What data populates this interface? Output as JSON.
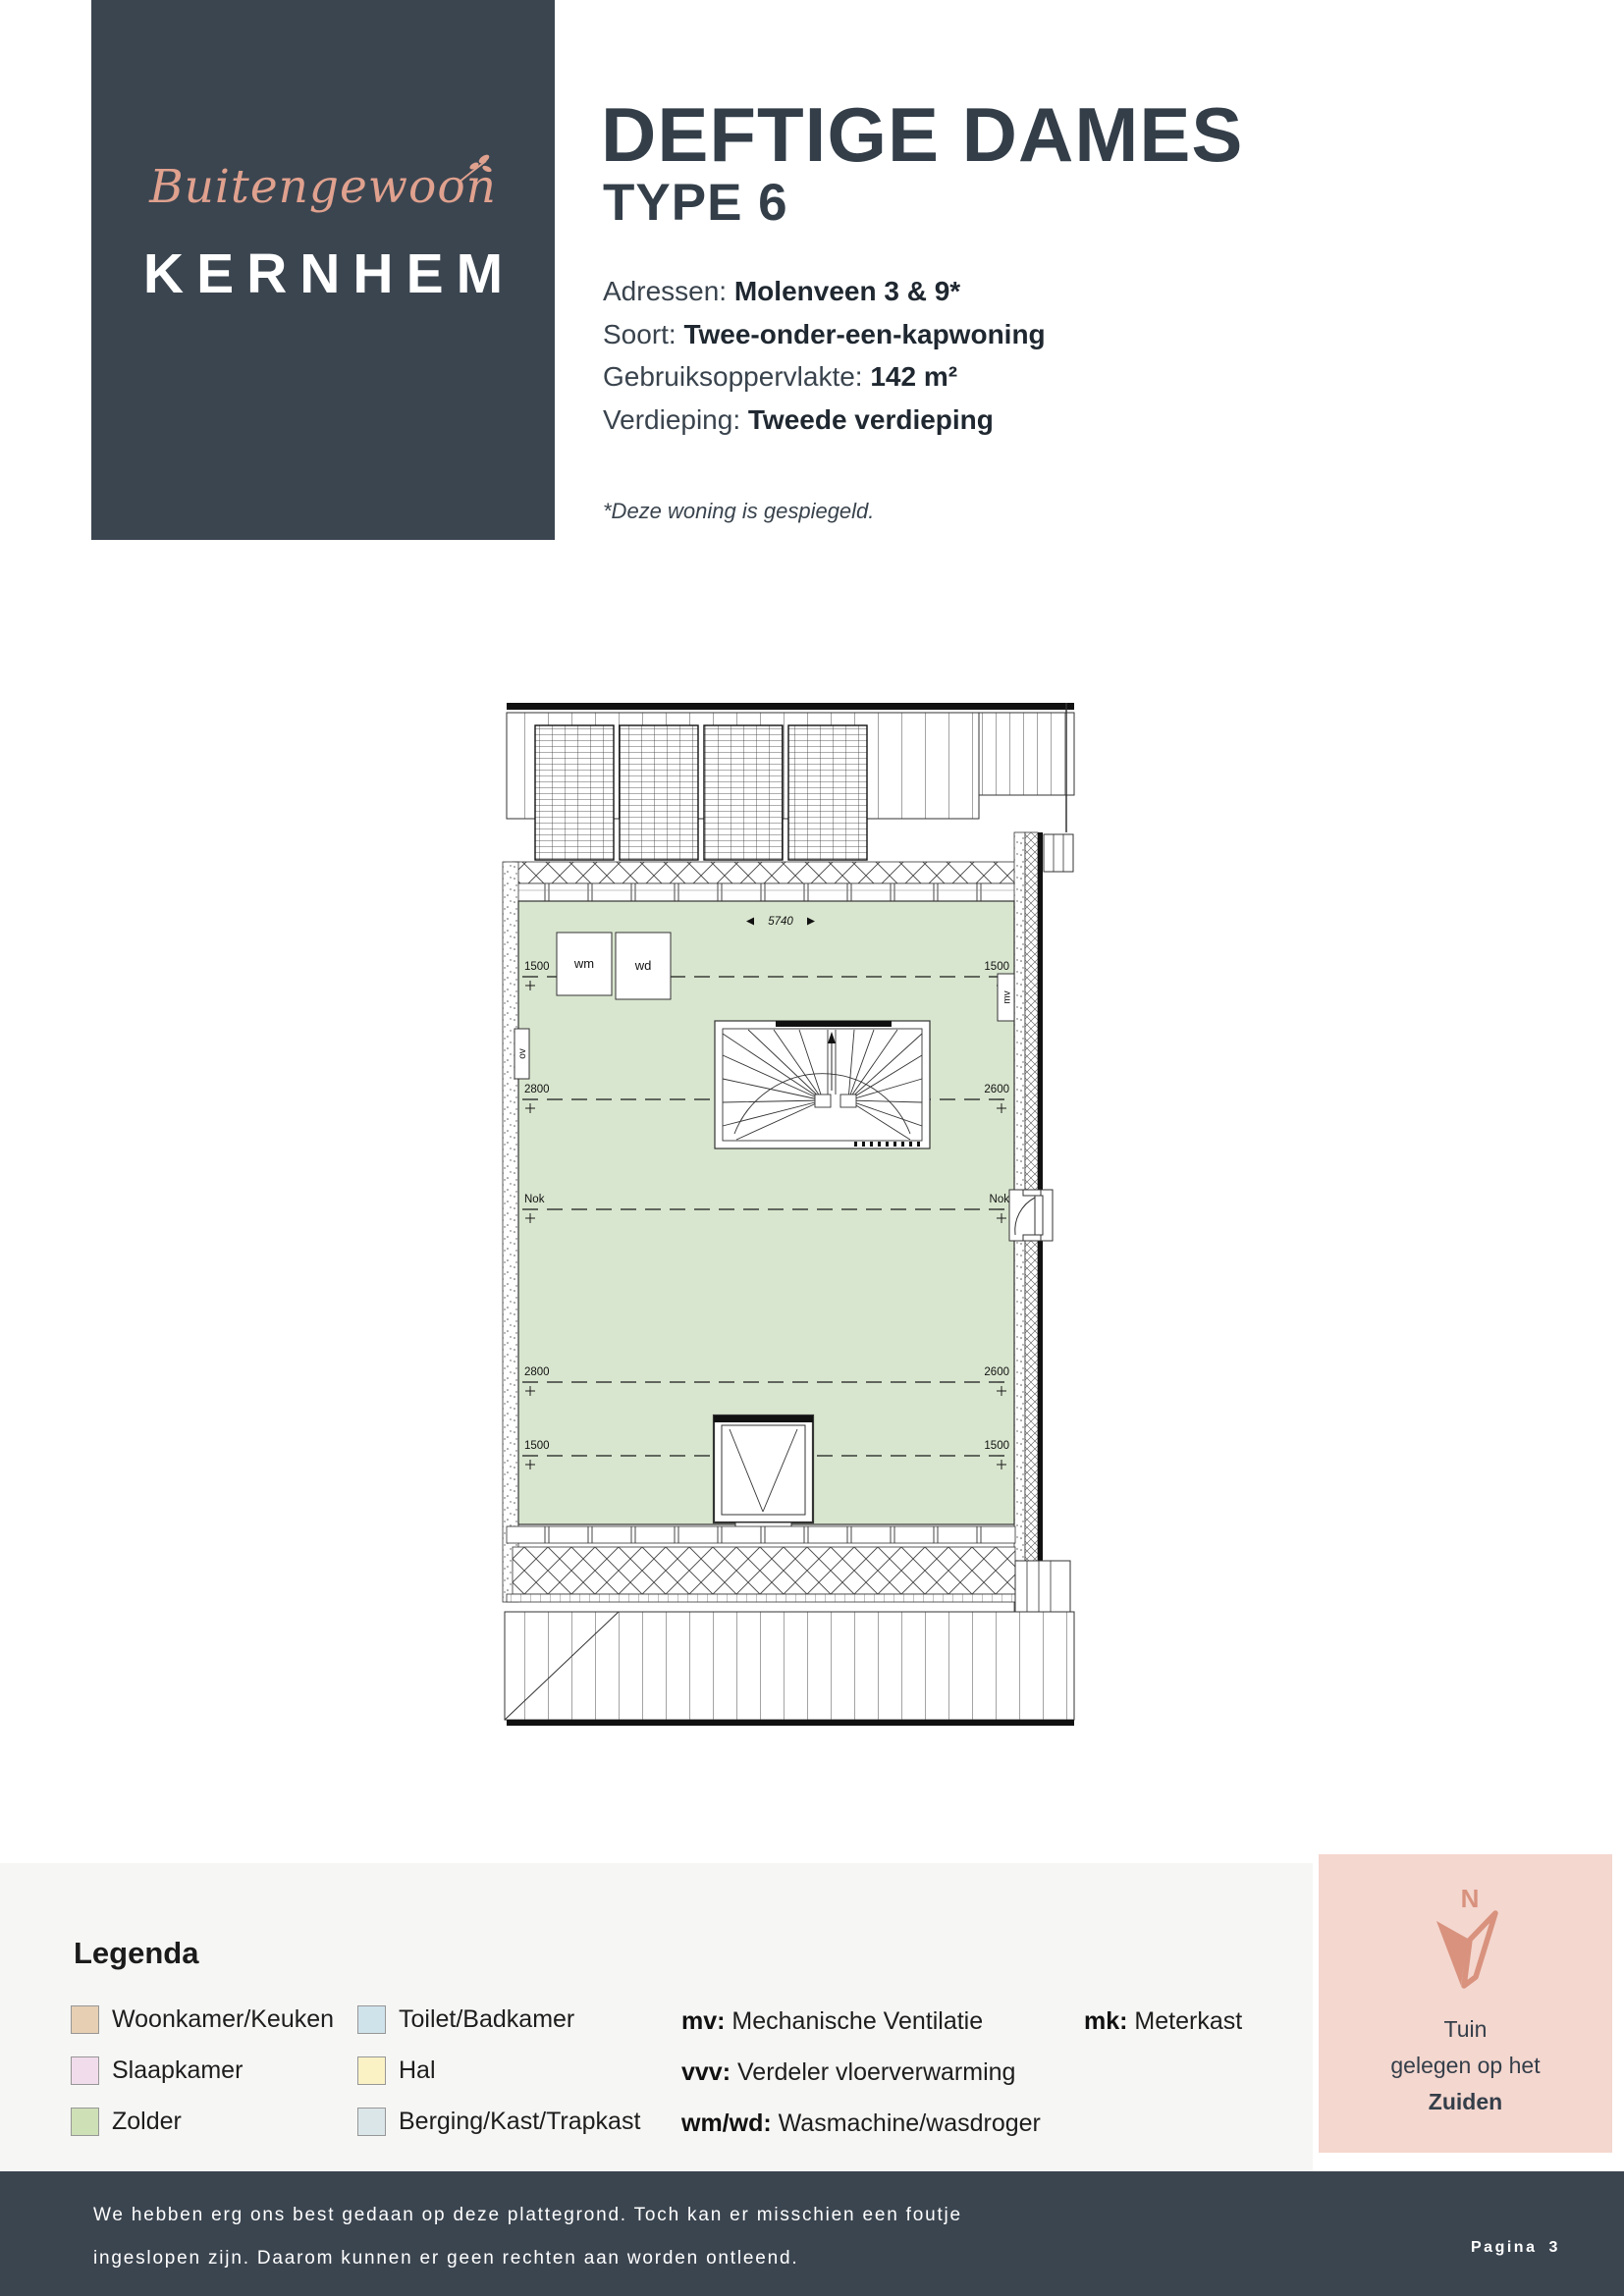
{
  "theme": {
    "dark": "#3b4550",
    "salmon": "#e0a18e"
  },
  "logo": {
    "script_text": "Buitengewoon",
    "brand": "KERNHEM"
  },
  "header": {
    "title": "DEFTIGE DAMES",
    "subtitle": "TYPE 6",
    "info": [
      {
        "label": "Adressen:",
        "value": "Molenveen 3 & 9*"
      },
      {
        "label": "Soort:",
        "value": "Twee-onder-een-kapwoning"
      },
      {
        "label": "Gebruiksoppervlakte:",
        "value": "142 m²"
      },
      {
        "label": "Verdieping:",
        "value": "Tweede verdieping"
      }
    ],
    "note": "*Deze woning is gespiegeld."
  },
  "floorplan": {
    "room_name": "Zolder",
    "room_fill": "#d9e6cf",
    "width_dim": "5740",
    "dim_rows": [
      {
        "left": "1500",
        "right": "1500"
      },
      {
        "left": "2800",
        "right": "2600"
      },
      {
        "left": "Nok",
        "right": "Nok"
      },
      {
        "left": "2800",
        "right": "2600"
      },
      {
        "left": "1500",
        "right": "1500"
      }
    ],
    "appliances": {
      "wm": "wm",
      "wd": "wd"
    },
    "fixtures": {
      "mv": "mv",
      "ov": "ov"
    }
  },
  "legend": {
    "title": "Legenda",
    "rooms": [
      {
        "label": "Woonkamer/Keuken",
        "color": "#e7cfb3"
      },
      {
        "label": "Slaapkamer",
        "color": "#f1dcec"
      },
      {
        "label": "Zolder",
        "color": "#cde0b6"
      },
      {
        "label": "Toilet/Badkamer",
        "color": "#cfe3eb"
      },
      {
        "label": "Hal",
        "color": "#faf2c5"
      },
      {
        "label": "Berging/Kast/Trapkast",
        "color": "#dbe6e9"
      }
    ],
    "abbreviations": [
      {
        "abbr": "mv:",
        "desc": "Mechanische Ventilatie"
      },
      {
        "abbr": "vvv:",
        "desc": "Verdeler vloerverwarming"
      },
      {
        "abbr": "wm/wd:",
        "desc": "Wasmachine/wasdroger"
      }
    ],
    "abbreviations_col2": [
      {
        "abbr": "mk:",
        "desc": "Meterkast"
      }
    ]
  },
  "compass": {
    "letter": "N",
    "line1": "Tuin",
    "line2": "gelegen op het",
    "line3": "Zuiden",
    "bg": "#f4d7cf",
    "arrow_color": "#d8927e"
  },
  "footer": {
    "line1": "We hebben erg ons best gedaan op deze plattegrond. Toch kan er misschien een foutje",
    "line2": "ingeslopen zijn. Daarom kunnen er geen rechten aan worden ontleend.",
    "page_label": "Pagina",
    "page_number": "3",
    "bg": "#3b4550"
  }
}
